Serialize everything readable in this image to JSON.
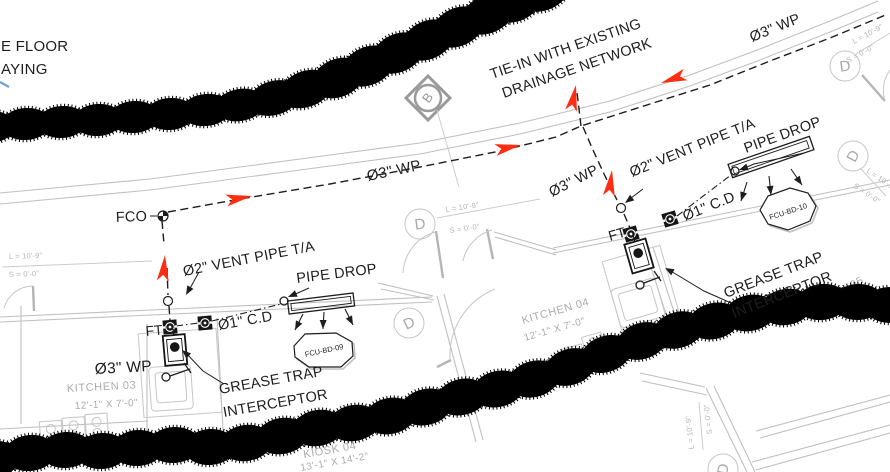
{
  "colors": {
    "flow_arrow": "#ff2d12",
    "ink": "#1e1e1e",
    "line_gray": "#c0c0c0",
    "text_gray": "#ababab",
    "blue_mark": "#6fa0d8"
  },
  "cutoff_note": {
    "line1": "E FLOOR",
    "line2": "AYING"
  },
  "annotations": {
    "tie_in_line1": "TIE-IN WITH EXISTING",
    "tie_in_line2": "DRAINAGE NETWORK",
    "wp3": "Ø3\" WP",
    "vent2": "Ø2\" VENT PIPE T/A",
    "pipe_drop": "PIPE DROP",
    "fco": "FCO",
    "ft": "FT",
    "cd1": "Ø1\" C.D",
    "grease_line1": "GREASE TRAP",
    "grease_line2": "INTERCEPTOR"
  },
  "equipment_tags": {
    "fcu_left": "FCU-BD-09",
    "fcu_right": "FCU-BD-10"
  },
  "rooms": {
    "kitchen03_name": "KITCHEN 03",
    "kitchen03_dims": "12'-1\" X 7'-0\"",
    "kitchen04_name": "KITCHEN 04",
    "kitchen04_dims": "12'-1\" X 7'-0\"",
    "kiosk04_name": "KIOSK 04",
    "kiosk04_dims": "13'-1\" X 14'-2\"",
    "kiosk05_name": "KIOSK 05"
  },
  "door_tags": {
    "letter": "D",
    "dim_length": "L = 10'-9\"",
    "dim_sill": "S = 0'-0\""
  },
  "grid_bubble": {
    "letter": "B"
  }
}
